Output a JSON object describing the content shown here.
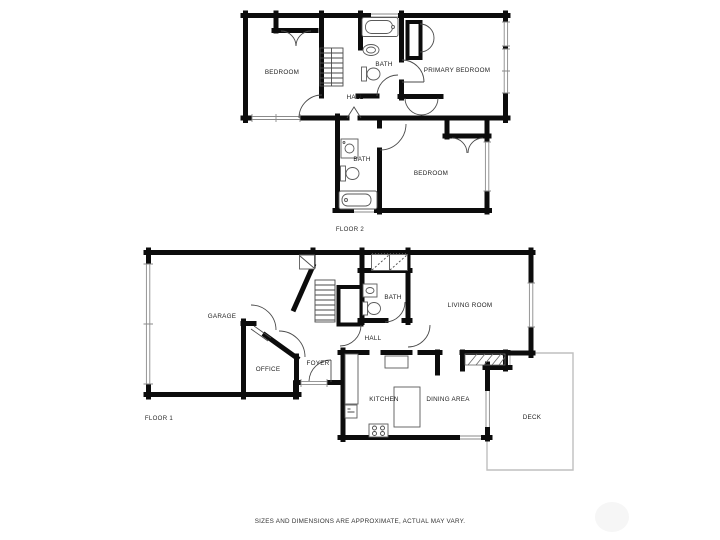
{
  "floor2": {
    "caption": "FLOOR 2",
    "rooms": {
      "bedroom_left": "BEDROOM",
      "bath_top": "BATH",
      "primary_bedroom": "PRIMARY BEDROOM",
      "hall": "HALL",
      "bath_lower": "BATH",
      "bedroom_lower": "BEDROOM"
    }
  },
  "floor1": {
    "caption": "FLOOR 1",
    "rooms": {
      "garage": "GARAGE",
      "office": "OFFICE",
      "foyer": "FOYER",
      "hall": "HALL",
      "bath": "BATH",
      "living_room": "LIVING ROOM",
      "kitchen": "KITCHEN",
      "dining_area": "DINING AREA",
      "deck": "DECK"
    }
  },
  "footer": {
    "disclaimer": "SIZES AND DIMENSIONS ARE APPROXIMATE, ACTUAL MAY VARY."
  }
}
